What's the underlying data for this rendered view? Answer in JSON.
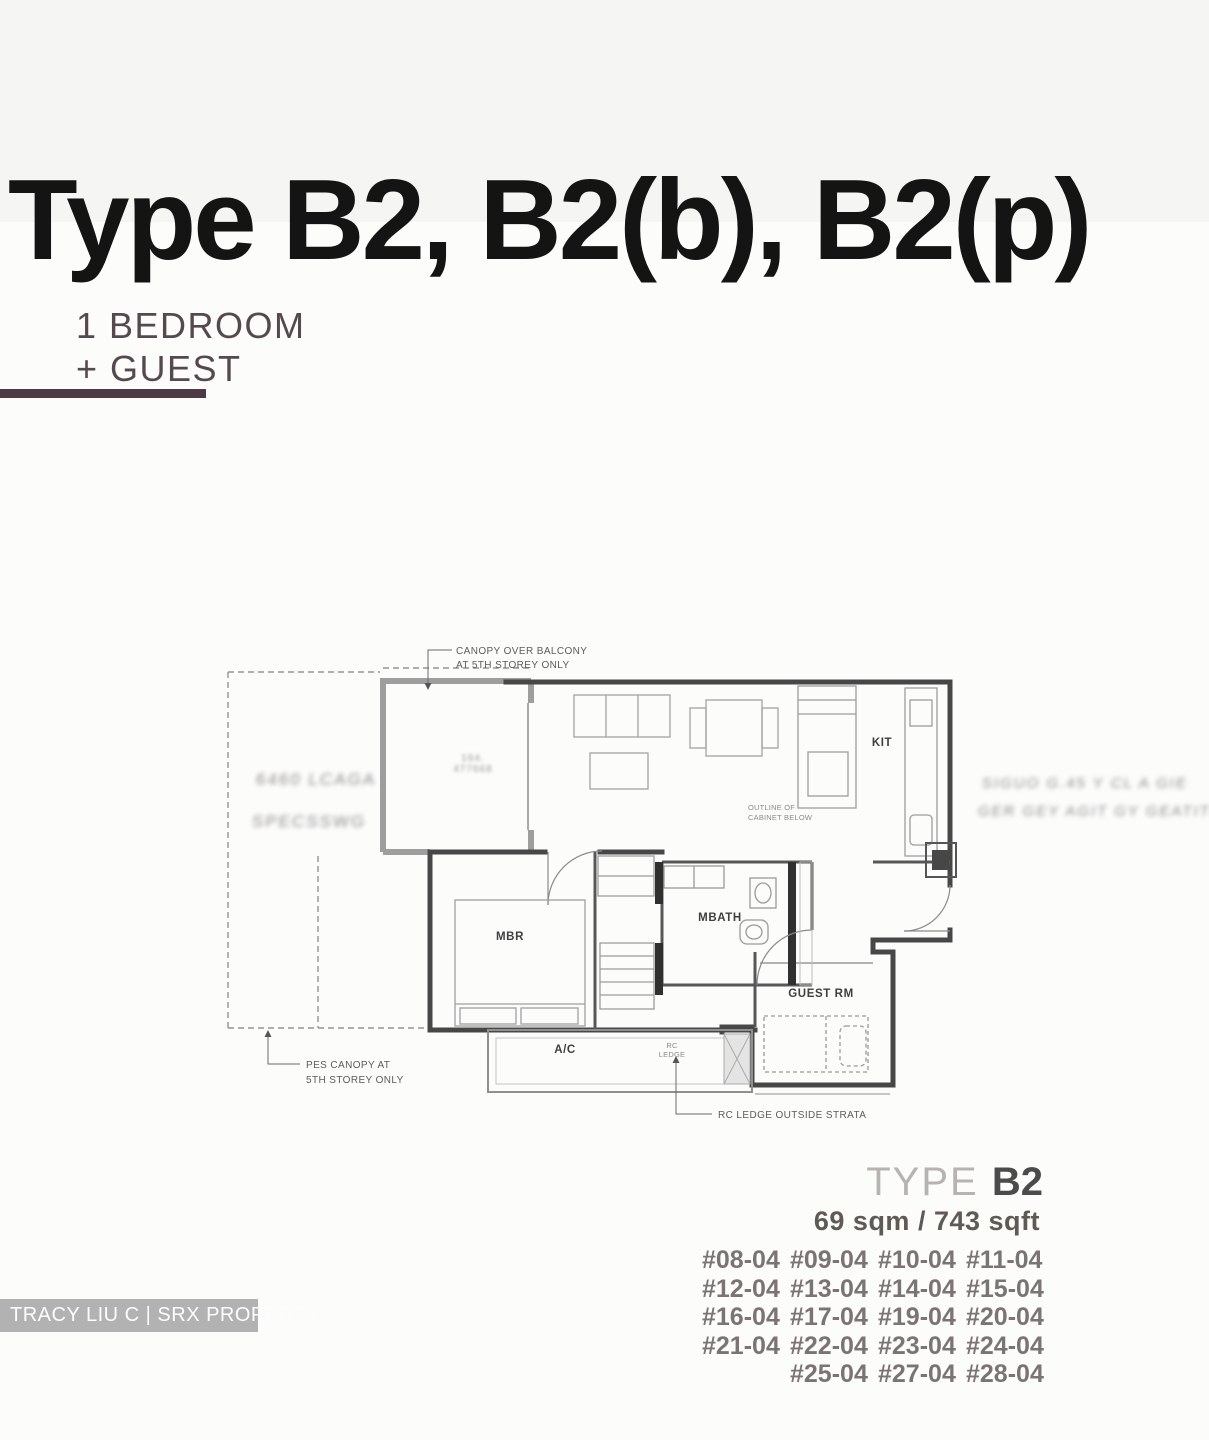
{
  "header": {
    "title": "Type B2, B2(b), B2(p)"
  },
  "unit_label": {
    "line1": "1 BEDROOM",
    "line2": "+ GUEST"
  },
  "floorplan": {
    "rooms": {
      "kitchen": "KIT",
      "master_bedroom": "MBR",
      "master_bath": "MBATH",
      "guest_room": "GUEST RM",
      "ac_ledge": "A/C",
      "rc_ledge_line1": "RC",
      "rc_ledge_line2": "LEDGE"
    },
    "annotations": {
      "canopy_line1": "CANOPY OVER BALCONY",
      "canopy_line2": "AT 5TH STOREY ONLY",
      "pes_line1": "PES CANOPY AT",
      "pes_line2": "5TH STOREY ONLY",
      "rc_outside": "RC LEDGE OUTSIDE STRATA",
      "cabinet_line1": "OUTLINE OF",
      "cabinet_line2": "CABINET BELOW"
    },
    "blurred_stamps": {
      "left_line1": "6460 LCAGA",
      "left_line2": "SPECSSWG",
      "right_line1": "SIGUO G.45 Y CL A GIE",
      "right_line2": "GER GEY AGIT GY GEATITL",
      "balcony_line1": "164.",
      "balcony_line2": "477668"
    }
  },
  "type_info": {
    "type_label": "TYPE",
    "type_value": "B2",
    "area": "69 sqm / 743 sqft"
  },
  "unit_rows": [
    [
      "#08-04",
      "#09-04",
      "#10-04",
      "#11-04"
    ],
    [
      "#12-04",
      "#13-04",
      "#14-04",
      "#15-04"
    ],
    [
      "#16-04",
      "#17-04",
      "#19-04",
      "#20-04"
    ],
    [
      "#21-04",
      "#22-04",
      "#23-04",
      "#24-04"
    ],
    [
      "",
      "#25-04",
      "#27-04",
      "#28-04"
    ]
  ],
  "watermark": "TRACY LIU C | SRX PROPERTY"
}
